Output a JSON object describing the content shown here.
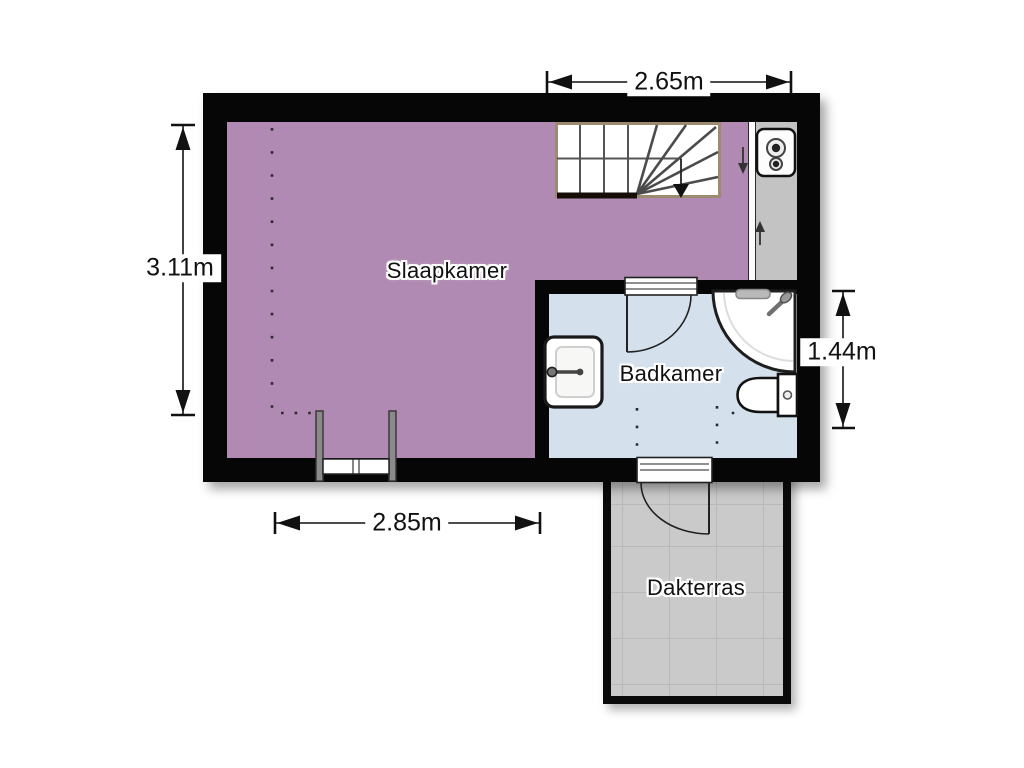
{
  "type": "floor-plan",
  "rooms": {
    "bedroom": {
      "label": "Slaapkamer",
      "color": "#b08ab2"
    },
    "bathroom": {
      "label": "Badkamer",
      "color": "#d4e1ed"
    },
    "terrace": {
      "label": "Dakterras",
      "color": "#cacaca"
    }
  },
  "dimensions": {
    "top": {
      "label": "2.65m",
      "orientation": "horizontal"
    },
    "left": {
      "label": "3.11m",
      "orientation": "vertical"
    },
    "bottom": {
      "label": "2.85m",
      "orientation": "horizontal"
    },
    "right": {
      "label": "1.44m",
      "orientation": "vertical"
    }
  },
  "fixtures": [
    "staircase-with-winders",
    "stair-walk-line-down-arrow",
    "corridor-down-arrow",
    "closet-up-arrow",
    "boiler",
    "washbasin",
    "corner-shower",
    "toilet",
    "bathroom-door",
    "terrace-door",
    "dormer-window",
    "sloped-ceiling-dotted-lines"
  ],
  "colors": {
    "wall": "#060606",
    "stair_trim": "#9b8b71",
    "terrace_grid": "#b9b9b9",
    "background": "#ffffff"
  }
}
